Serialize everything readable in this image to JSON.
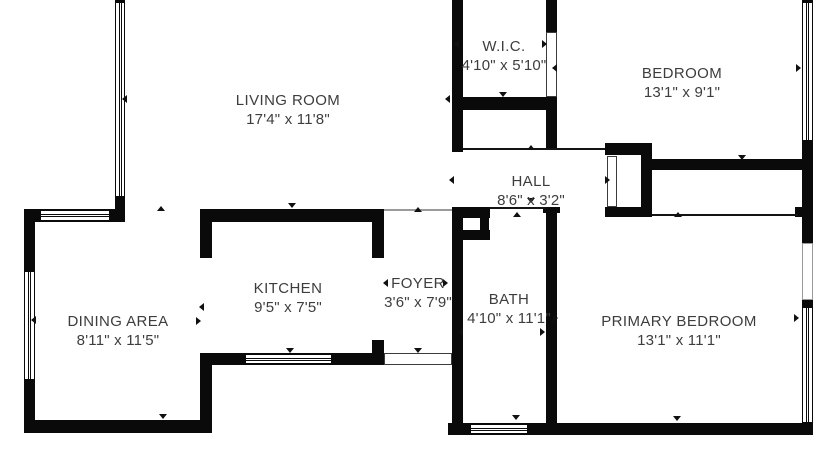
{
  "colors": {
    "wall": "#0a0a0a",
    "text": "#3d3d3d",
    "background": "#ffffff"
  },
  "rooms": [
    {
      "id": "living-room",
      "name": "LIVING ROOM",
      "dims": "17'4\" x 11'8\"",
      "cx": 288,
      "cy": 110
    },
    {
      "id": "wic",
      "name": "W.I.C.",
      "dims": "4'10\" x 5'10\"",
      "cx": 504,
      "cy": 56
    },
    {
      "id": "bedroom",
      "name": "BEDROOM",
      "dims": "13'1\" x 9'1\"",
      "cx": 682,
      "cy": 83
    },
    {
      "id": "hall",
      "name": "HALL",
      "dims": "8'6\" x 3'2\"",
      "cx": 531,
      "cy": 191
    },
    {
      "id": "dining-area",
      "name": "DINING AREA",
      "dims": "8'11\" x 11'5\"",
      "cx": 118,
      "cy": 331
    },
    {
      "id": "kitchen",
      "name": "KITCHEN",
      "dims": "9'5\" x 7'5\"",
      "cx": 288,
      "cy": 298
    },
    {
      "id": "foyer",
      "name": "FOYER",
      "dims": "3'6\" x 7'9\"",
      "cx": 418,
      "cy": 293
    },
    {
      "id": "bath",
      "name": "BATH",
      "dims": "4'10\" x 11'1\"",
      "cx": 509,
      "cy": 309
    },
    {
      "id": "primary-bedroom",
      "name": "PRIMARY BEDROOM",
      "dims": "13'1\" x 11'1\"",
      "cx": 679,
      "cy": 331
    }
  ],
  "geometry": {
    "walls": [
      [
        115,
        0,
        10,
        3
      ],
      [
        115,
        196,
        10,
        26
      ],
      [
        24,
        209,
        101,
        13
      ],
      [
        24,
        209,
        11,
        224
      ],
      [
        24,
        420,
        188,
        13
      ],
      [
        200,
        209,
        12,
        49
      ],
      [
        200,
        355,
        12,
        68
      ],
      [
        200,
        209,
        184,
        13
      ],
      [
        372,
        222,
        12,
        36
      ],
      [
        372,
        340,
        12,
        25
      ],
      [
        200,
        353,
        184,
        12
      ],
      [
        452,
        0,
        11,
        152
      ],
      [
        546,
        0,
        11,
        32
      ],
      [
        546,
        97,
        11,
        51
      ],
      [
        452,
        97,
        105,
        13
      ],
      [
        452,
        207,
        11,
        216
      ],
      [
        462,
        207,
        28,
        11
      ],
      [
        480,
        218,
        9,
        14
      ],
      [
        460,
        230,
        30,
        10
      ],
      [
        543,
        207,
        17,
        6
      ],
      [
        546,
        208,
        11,
        215
      ],
      [
        605,
        143,
        47,
        12
      ],
      [
        641,
        143,
        11,
        74
      ],
      [
        605,
        207,
        47,
        10
      ],
      [
        650,
        159,
        163,
        11
      ],
      [
        795,
        207,
        7,
        10
      ],
      [
        802,
        0,
        11,
        3
      ],
      [
        802,
        141,
        11,
        102
      ],
      [
        802,
        300,
        11,
        7
      ],
      [
        448,
        423,
        365,
        12
      ]
    ],
    "windows": [
      {
        "r": [
          115,
          2,
          10,
          195
        ],
        "o": "v"
      },
      {
        "r": [
          40,
          210,
          70,
          11
        ],
        "o": "h"
      },
      {
        "r": [
          24,
          271,
          11,
          109
        ],
        "o": "v"
      },
      {
        "r": [
          245,
          354,
          87,
          10
        ],
        "o": "h"
      },
      {
        "r": [
          470,
          424,
          58,
          10
        ],
        "o": "h"
      },
      {
        "r": [
          802,
          2,
          11,
          139
        ],
        "o": "v"
      },
      {
        "r": [
          802,
          307,
          11,
          116
        ],
        "o": "v"
      }
    ],
    "openings": [
      {
        "r": [
          546,
          32,
          11,
          65
        ],
        "faint": false
      },
      {
        "r": [
          384,
          353,
          68,
          12
        ],
        "faint": false
      },
      {
        "r": [
          607,
          156,
          10,
          51
        ],
        "faint": false
      },
      {
        "r": [
          802,
          243,
          11,
          57
        ],
        "faint": true
      }
    ],
    "thin_lines": [
      {
        "r": [
          463,
          148,
          142,
          2
        ],
        "faint": false
      },
      {
        "r": [
          490,
          207,
          56,
          2
        ],
        "faint": false
      },
      {
        "r": [
          652,
          214,
          146,
          2
        ],
        "faint": false
      },
      {
        "r": [
          384,
          209,
          68,
          2
        ],
        "faint": true
      }
    ],
    "markers": [
      [
        126,
        98,
        "l"
      ],
      [
        35,
        319,
        "l"
      ],
      [
        161,
        209,
        "u"
      ],
      [
        292,
        206,
        "d"
      ],
      [
        203,
        306,
        "l"
      ],
      [
        200,
        320,
        "r"
      ],
      [
        163,
        417,
        "d"
      ],
      [
        290,
        351,
        "d"
      ],
      [
        418,
        210,
        "u"
      ],
      [
        418,
        351,
        "d"
      ],
      [
        387,
        282,
        "l"
      ],
      [
        447,
        282,
        "r"
      ],
      [
        449,
        98,
        "l"
      ],
      [
        458,
        43,
        "l"
      ],
      [
        546,
        43,
        "r"
      ],
      [
        556,
        67,
        "l"
      ],
      [
        503,
        95,
        "d"
      ],
      [
        531,
        148,
        "u"
      ],
      [
        453,
        179,
        "l"
      ],
      [
        609,
        179,
        "r"
      ],
      [
        531,
        201,
        "d"
      ],
      [
        517,
        215,
        "u"
      ],
      [
        462,
        331,
        "l"
      ],
      [
        544,
        331,
        "r"
      ],
      [
        557,
        317,
        "r"
      ],
      [
        800,
        67,
        "r"
      ],
      [
        742,
        158,
        "d"
      ],
      [
        678,
        215,
        "u"
      ],
      [
        798,
        317,
        "r"
      ],
      [
        677,
        419,
        "d"
      ],
      [
        516,
        418,
        "d"
      ]
    ]
  }
}
